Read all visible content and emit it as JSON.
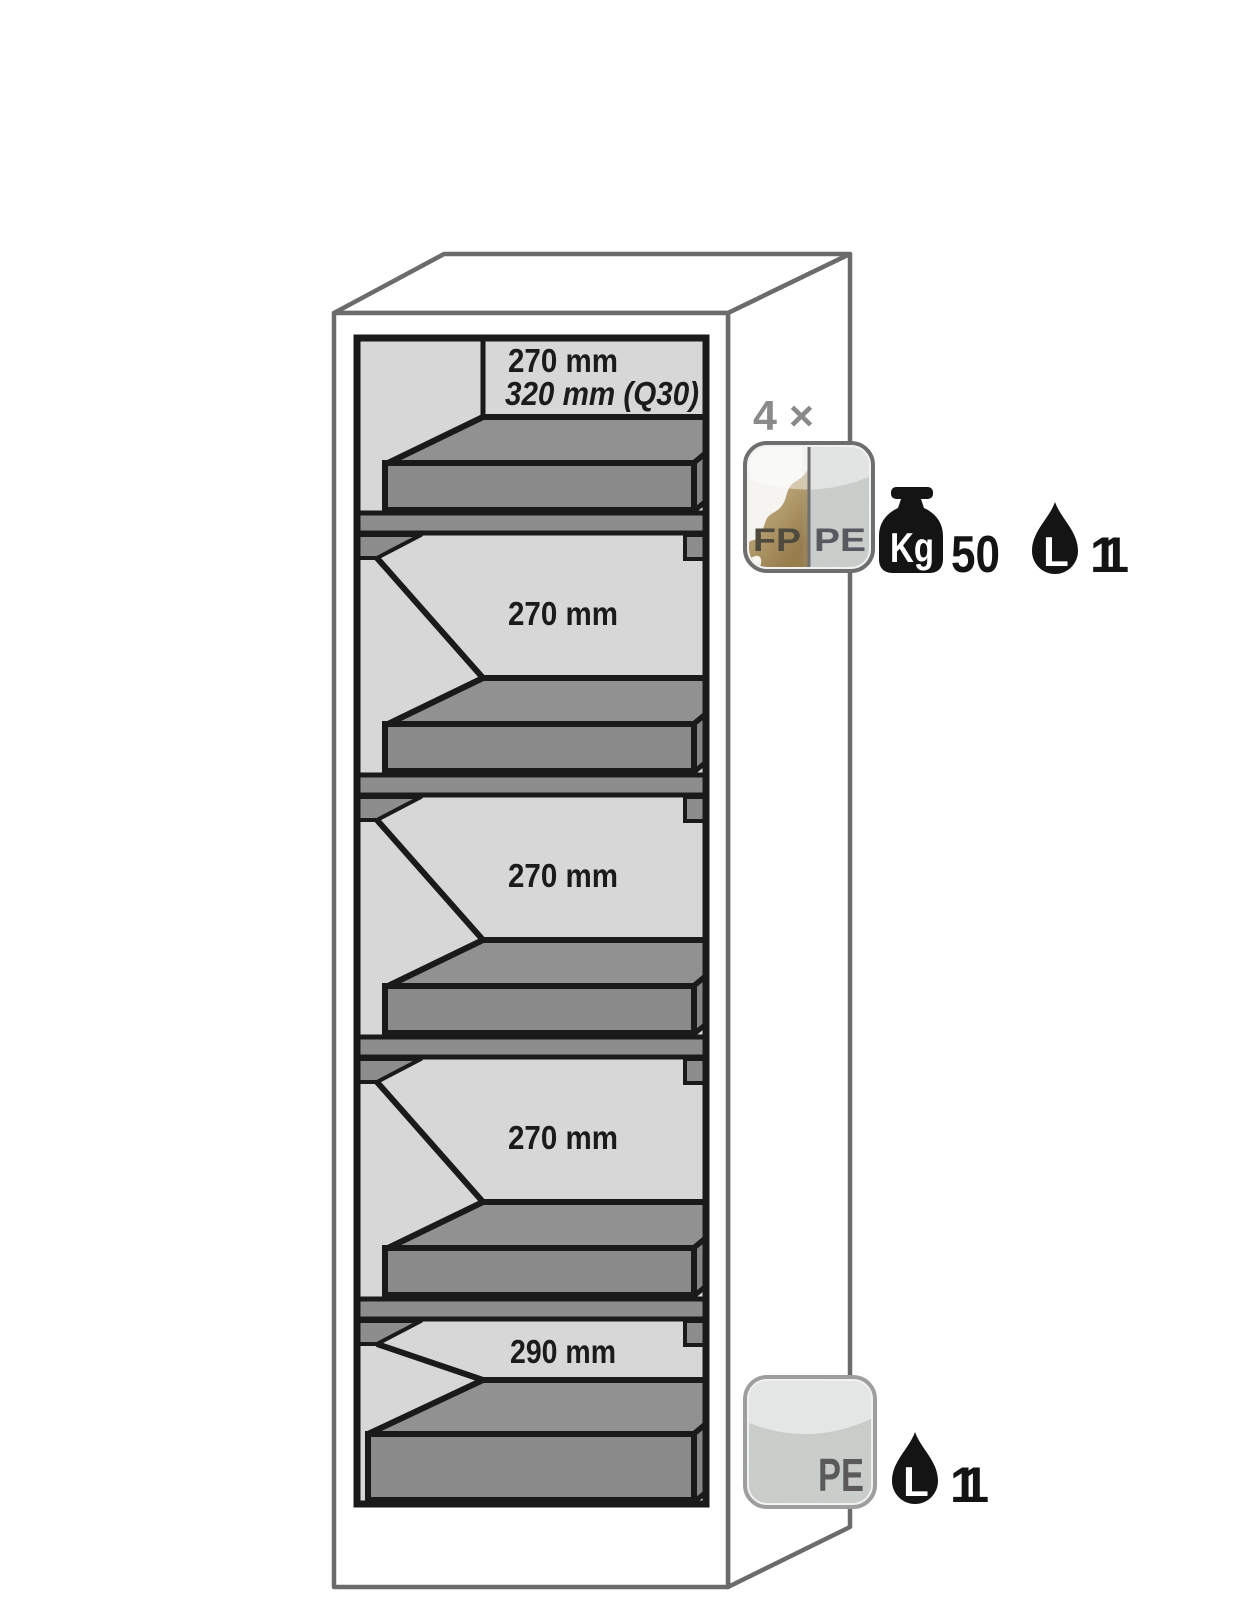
{
  "cabinet": {
    "compartments": [
      {
        "height": "270 mm",
        "height_alt": "320 mm (Q30)"
      },
      {
        "height": "270 mm"
      },
      {
        "height": "270 mm"
      },
      {
        "height": "270 mm"
      },
      {
        "height": "290 mm"
      }
    ]
  },
  "tray_badge": {
    "quantity": "4 ×",
    "material_left": "FP",
    "material_right": "PE",
    "load_unit": "Kg",
    "load_value": "50",
    "volume_unit": "L",
    "volume_value": "11"
  },
  "sump_badge": {
    "material": "PE",
    "volume_unit": "L",
    "volume_value": "11"
  },
  "colors": {
    "outline_gray": "#6b6b6b",
    "frame_black": "#1a1a1a",
    "interior_gray": "#d7d7d7",
    "tray_top": "#919191",
    "tray_front": "#8a8a8a",
    "tray_side": "#858585",
    "label_gray": "#8a8a8a",
    "fp_gold": "#a98e5d",
    "pe_speckle_gray": "#ced2cf",
    "icon_black": "#141414"
  }
}
